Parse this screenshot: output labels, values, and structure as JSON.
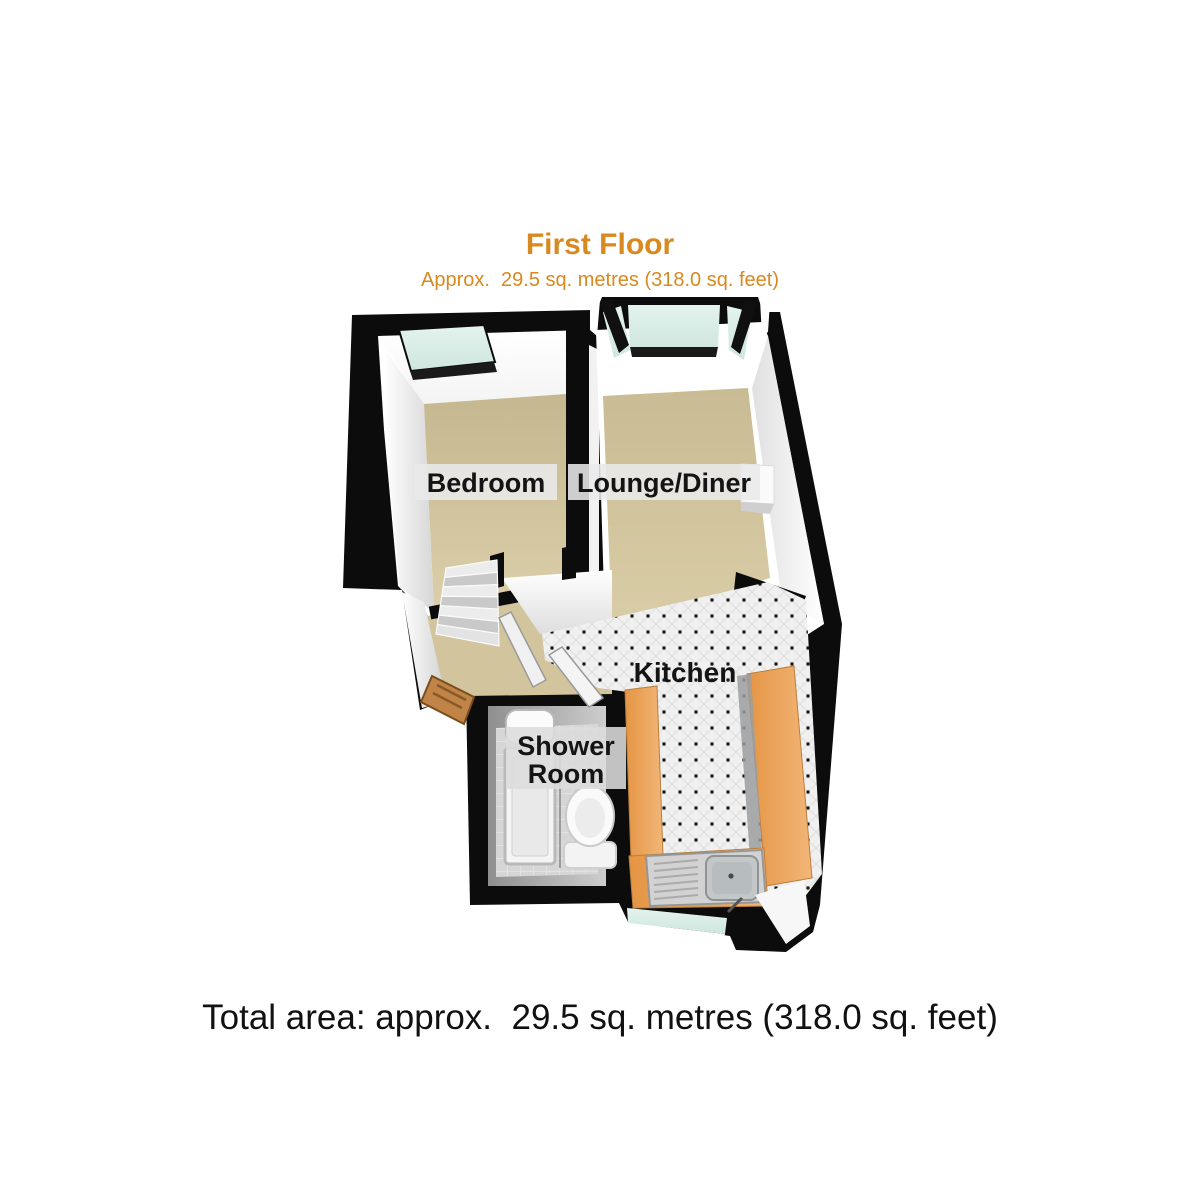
{
  "header": {
    "title": "First Floor",
    "subtitle": "Approx.  29.5 sq. metres (318.0 sq. feet)",
    "title_color": "#d8891f"
  },
  "footer": {
    "total_area": "Total area: approx.  29.5 sq. metres (318.0 sq. feet)"
  },
  "plan": {
    "floor_name": "First Floor",
    "rooms": [
      {
        "id": "bedroom",
        "label": "Bedroom"
      },
      {
        "id": "lounge-diner",
        "label": "Lounge/Diner"
      },
      {
        "id": "kitchen",
        "label": "Kitchen"
      },
      {
        "id": "shower-room",
        "label": "Shower Room",
        "label_line1": "Shower",
        "label_line2": "Room"
      }
    ],
    "fixtures": [
      "bay-window",
      "bedroom-window",
      "kitchen-window",
      "staircase",
      "entrance-door",
      "interior-door",
      "interior-door",
      "kitchen-counters",
      "kitchen-sink",
      "shower-enclosure",
      "toilet"
    ],
    "colors": {
      "outer_wall": "#0c0c0c",
      "inner_wall": "#ffffff",
      "carpet_beige": "#cfc19b",
      "counter_orange": "#eba55d",
      "window_glass": "#d7ebe4",
      "kitchen_tile": "#f0f0f0",
      "tile_dot": "#1c1c1c",
      "shower_tile": "#d6d6d6",
      "label_text": "#141414",
      "label_band": "#e9e9e9",
      "wood_door": "#c08448"
    }
  }
}
